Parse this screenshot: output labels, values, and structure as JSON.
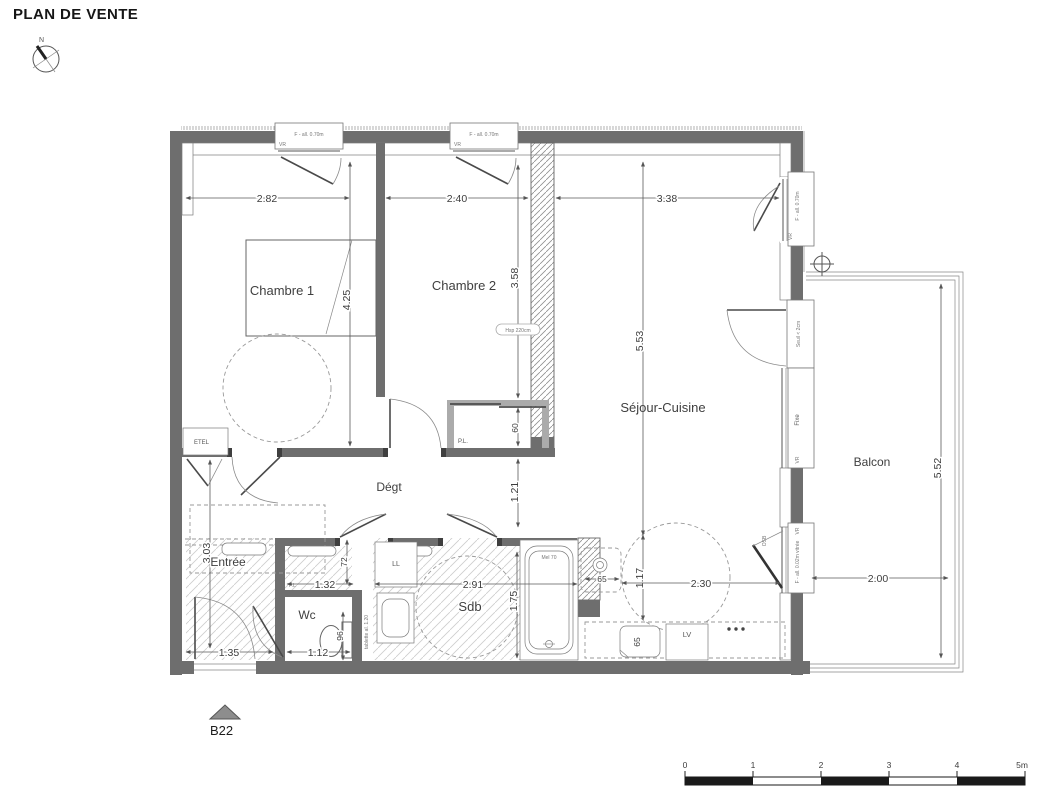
{
  "title": "PLAN DE VENTE",
  "compass": {
    "north": "N"
  },
  "lot": {
    "id": "B22"
  },
  "rooms": {
    "chambre1": "Chambre 1",
    "chambre2": "Chambre 2",
    "sejour": "Séjour-Cuisine",
    "balcon": "Balcon",
    "degagement": "Dégt",
    "entree": "Entrée",
    "wc": "Wc",
    "sdb": "Sdb"
  },
  "labels": {
    "etel": "ETEL",
    "placard": "P.L.",
    "placard_small": "P.L",
    "lave_linge": "LL",
    "lave_vaisselle": "LV",
    "osb": "OSB",
    "fixe": "Fixe",
    "vr": "VR",
    "seuil": "Seuil < 2cm",
    "hsp": "Hsp 220cm",
    "window_070": "F - all. 0.70m",
    "window_002": "F - all. 0.02m vitrée",
    "bath": "Mel 70",
    "tablette": "tablette al. 1.20"
  },
  "dims": {
    "w_ch1": "2.82",
    "w_ch2": "2.40",
    "w_sejour": "3.38",
    "h_ch1": "4.25",
    "h_ch2": "3.58",
    "h_pl": "60",
    "h_sejour": "5.53",
    "h_degt": "1.21",
    "h_kitchen": "1.17",
    "w_kitchen": "2.30",
    "w_appliance": "65",
    "w_sink": "65",
    "h_entree": "3.03",
    "w_entree": "1.35",
    "w_wc": "1.12",
    "h_wc": "96",
    "w_nook": "1.32",
    "h_nook": "72",
    "w_sdb": "2.91",
    "h_sdb": "1.75",
    "w_balcon": "2.00",
    "h_balcon": "5.52"
  },
  "scalebar": {
    "t0": "0",
    "t1": "1",
    "t2": "2",
    "t3": "3",
    "t4": "4",
    "t5": "5m"
  }
}
